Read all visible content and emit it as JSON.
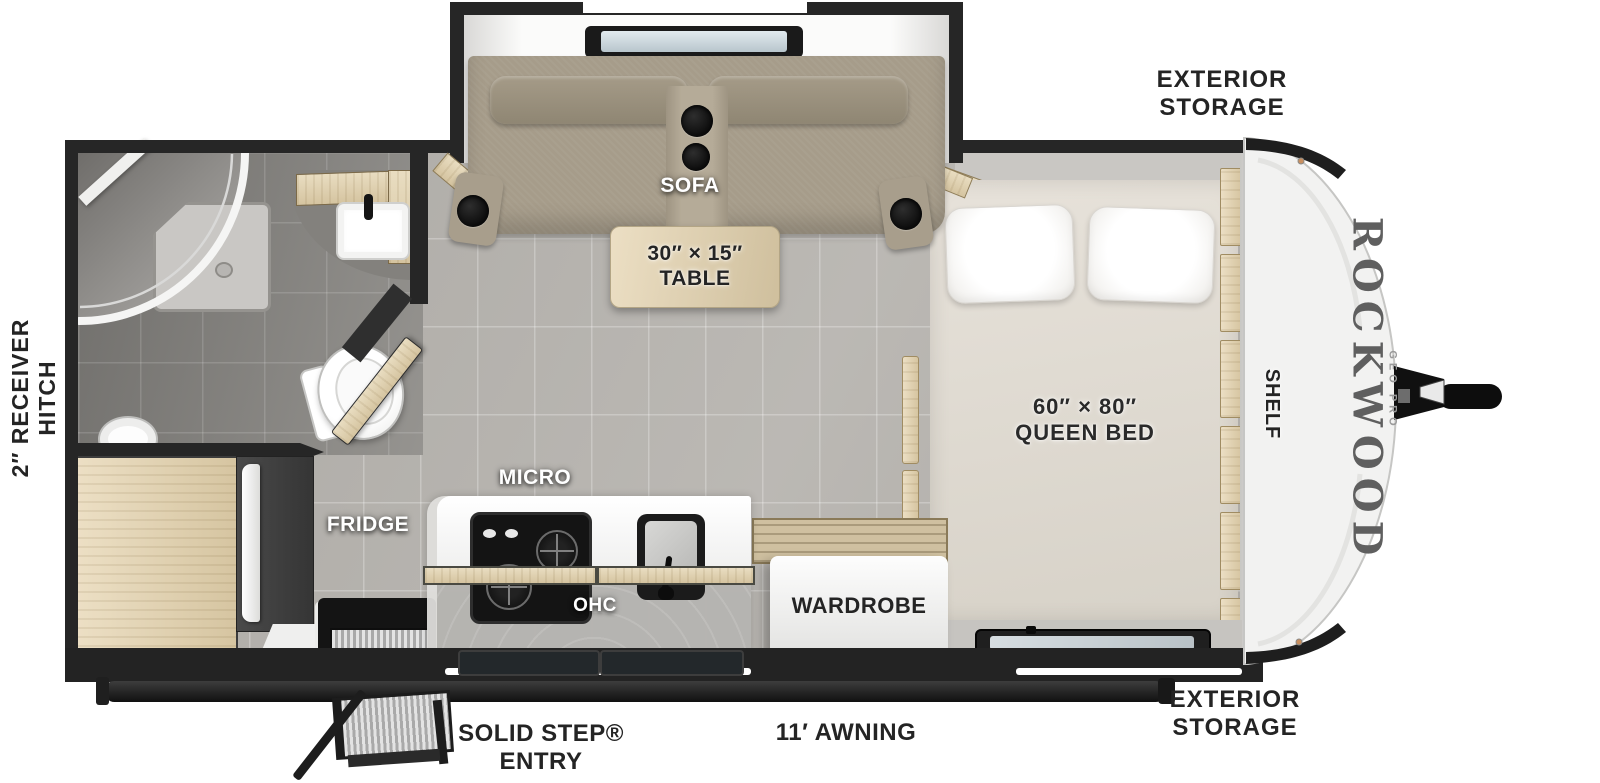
{
  "title": "Rockwood Geo Pro travel trailer floor plan",
  "brand": {
    "name": "ROCKWOOD",
    "series": "GEO PRO"
  },
  "labels": {
    "exterior_storage_top": [
      "EXTERIOR",
      "STORAGE"
    ],
    "exterior_storage_bottom": [
      "EXTERIOR",
      "STORAGE"
    ],
    "receiver_hitch": [
      "2″ RECEIVER",
      "HITCH"
    ],
    "sofa": "SOFA",
    "table": [
      "30″ × 15″",
      "TABLE"
    ],
    "queen_bed": [
      "60″ × 80″",
      "QUEEN BED"
    ],
    "shelf": "SHELF",
    "micro": "MICRO",
    "fridge": "FRIDGE",
    "ohc": "OHC",
    "wardrobe": "WARDROBE",
    "solid_step_entry": [
      "SOLID STEP®",
      "ENTRY"
    ],
    "awning": "11′ AWNING"
  },
  "colors": {
    "wall": "#262626",
    "floor_tile": "#b6b3ae",
    "wood": "#d9c9a6",
    "sofa_fabric": "#a69c8a",
    "mattress": "#e2ddd4",
    "front_cap": "#f2f2f1",
    "label_dark": "#242424",
    "label_light": "#ffffff"
  }
}
